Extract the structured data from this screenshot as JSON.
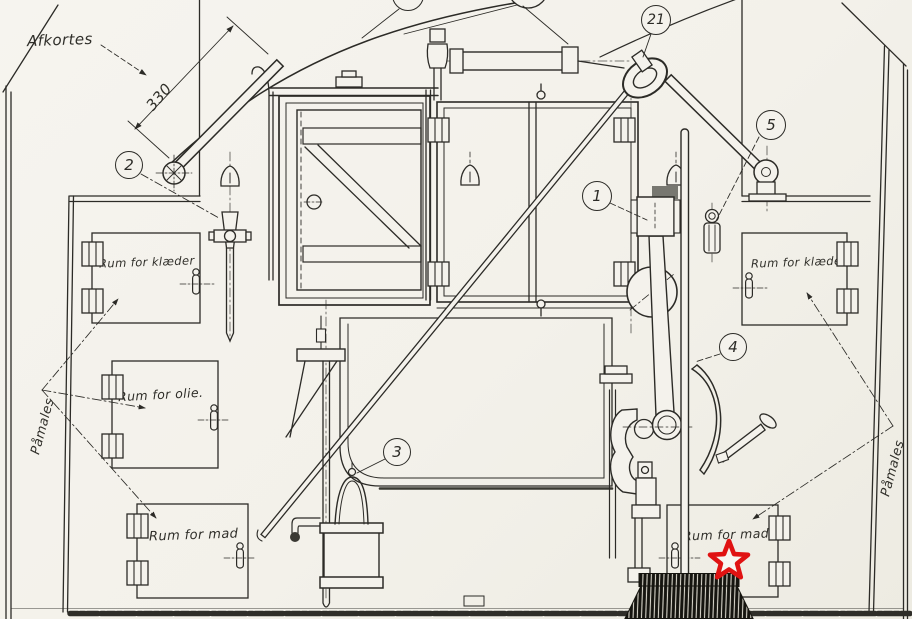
{
  "annotations": {
    "afkortes": "Afkortes",
    "dimension_330": "330",
    "paamales_left": "Påmales",
    "paamales_right": "Påmales"
  },
  "compartment_labels": {
    "clothes_left": "Rum for klæder",
    "oil": "Rum for olie.",
    "food_left": "Rum for mad",
    "clothes_right": "Rum for klæder.",
    "food_right": "Rum for mad"
  },
  "callouts": {
    "item_1": "1",
    "item_2": "2",
    "item_3": "3",
    "item_4": "4",
    "item_5": "5",
    "item_19_partial": "19",
    "item_21": "21"
  },
  "colors": {
    "paper": "#f4f2ec",
    "ink": "#2c2b27",
    "star_red": "#e01212"
  }
}
